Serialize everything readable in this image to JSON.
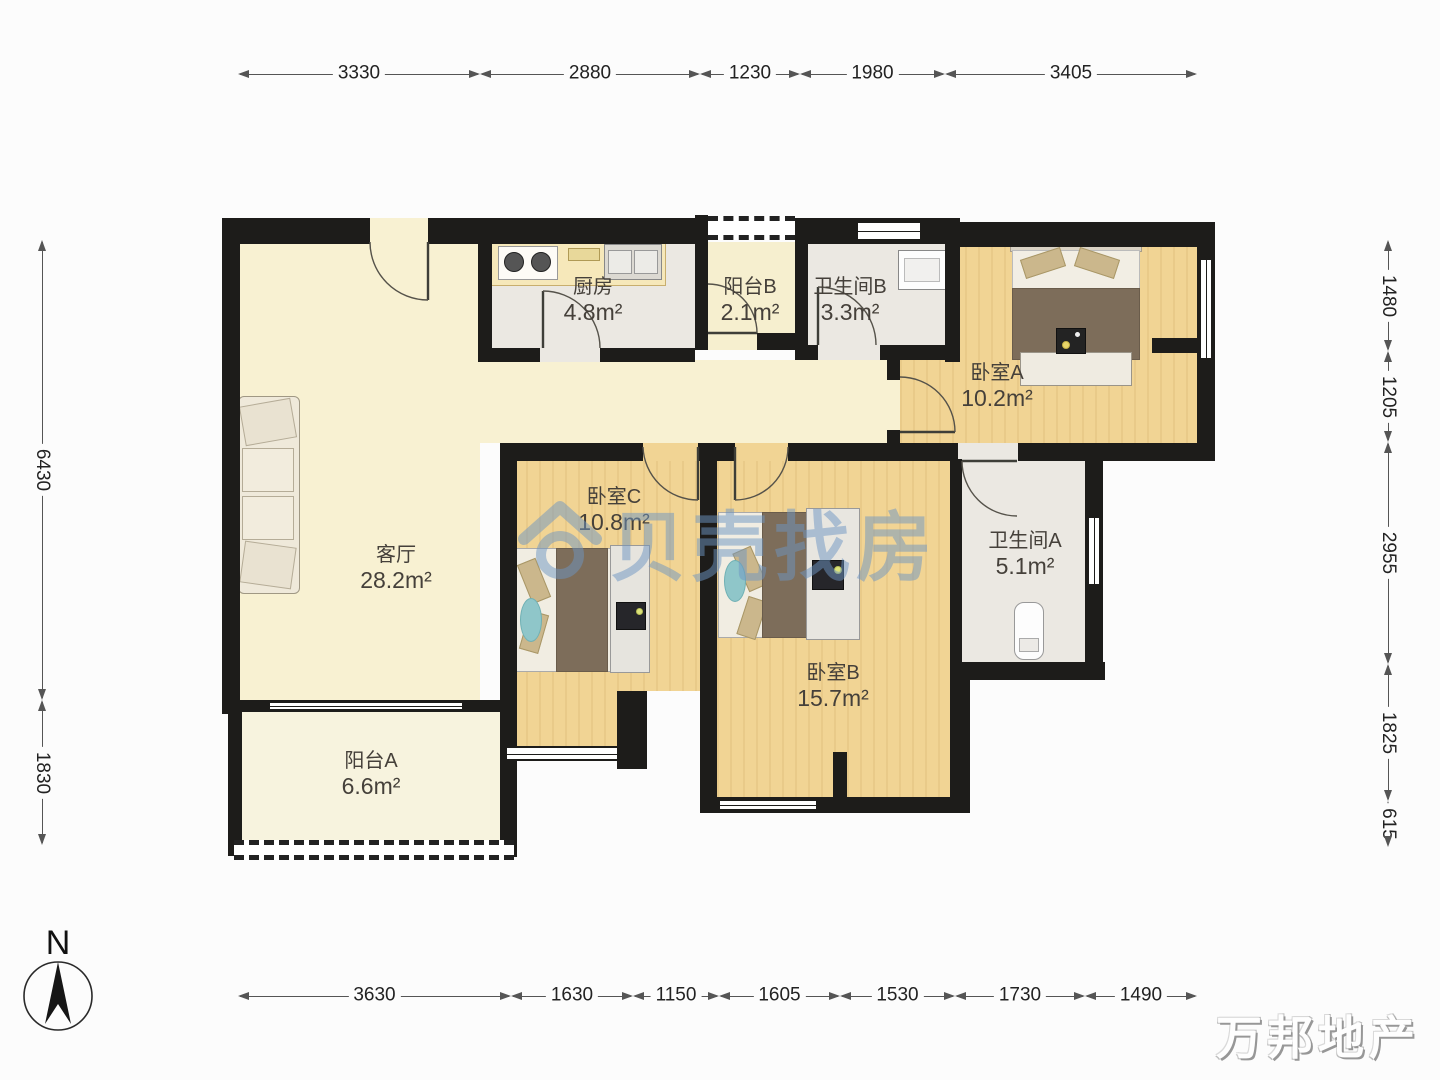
{
  "rooms": [
    {
      "name": "厨房",
      "area": "4.8m²"
    },
    {
      "name": "阳台B",
      "area": "2.1m²"
    },
    {
      "name": "卫生间B",
      "area": "3.3m²"
    },
    {
      "name": "卧室A",
      "area": "10.2m²"
    },
    {
      "name": "客厅",
      "area": "28.2m²"
    },
    {
      "name": "卧室C",
      "area": "10.8m²"
    },
    {
      "name": "卫生间A",
      "area": "5.1m²"
    },
    {
      "name": "卧室B",
      "area": "15.7m²"
    },
    {
      "name": "阳台A",
      "area": "6.6m²"
    }
  ],
  "dimensions": {
    "top": [
      "3330",
      "2880",
      "1230",
      "1980",
      "3405"
    ],
    "bottom": [
      "3630",
      "1630",
      "1150",
      "1605",
      "1530",
      "1730",
      "1490"
    ],
    "left": [
      "6430",
      "1830"
    ],
    "right": [
      "1480",
      "1205",
      "2955",
      "1825",
      "615"
    ]
  },
  "compass": {
    "north_label": "N"
  },
  "watermarks": {
    "brand_center": "贝壳找房",
    "brand_corner": "万邦地产"
  },
  "colors": {
    "wall": "#1d1c1a",
    "wood_floor": "#f1d494",
    "cream_floor": "#f8f1d2",
    "tile_floor": "#ebe8e2",
    "balcony_a_floor": "#f7f3de",
    "balcony_b_floor": "#f6efcf",
    "watermark_blue": "#6e96c3",
    "teal_rug": "#8fc6c9",
    "blanket_brown": "#7d6d5a",
    "pillow_tan": "#cbb78c",
    "counter_cream": "#f6e8ba"
  }
}
